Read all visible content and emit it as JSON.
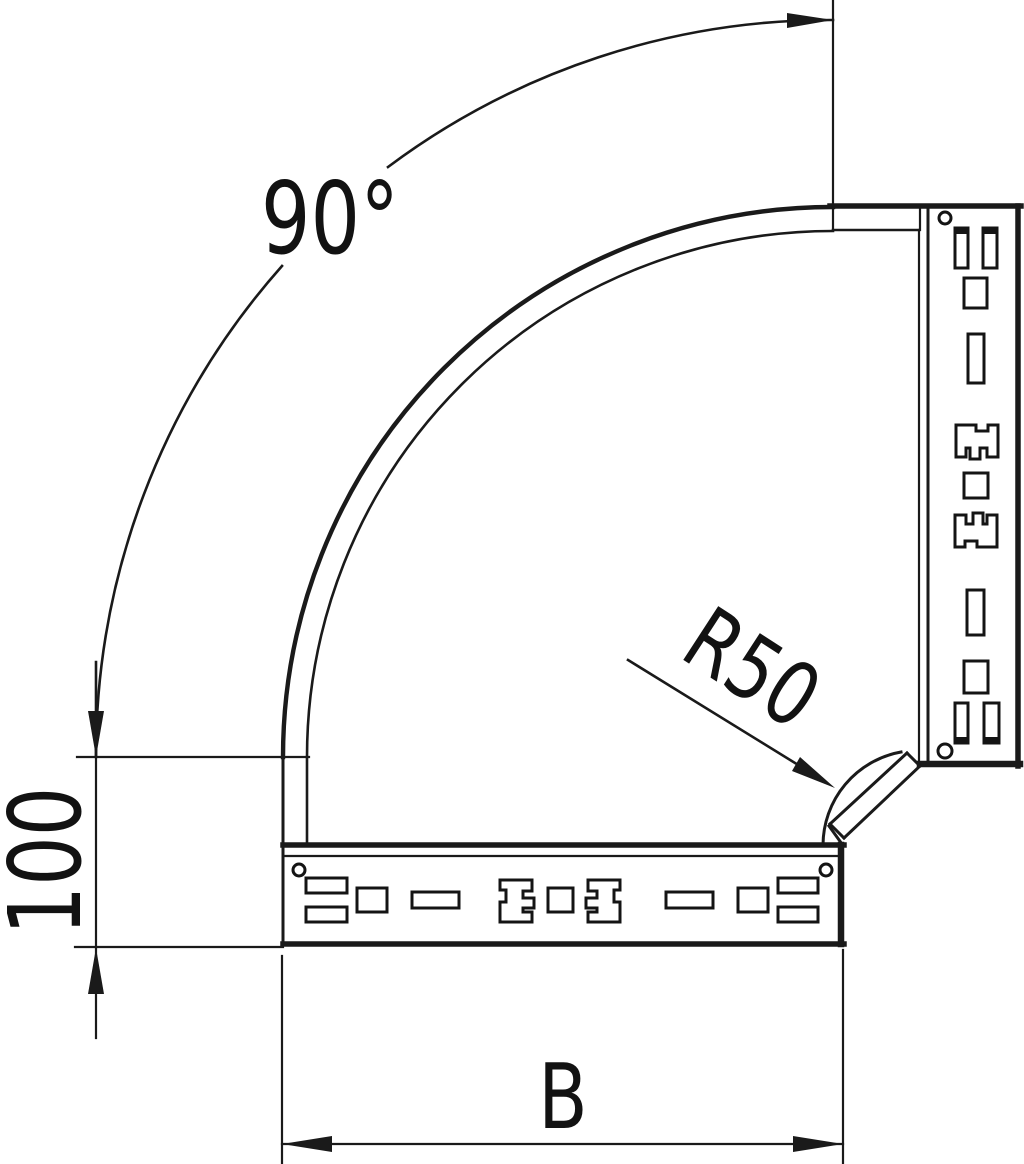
{
  "drawing": {
    "labels": {
      "angle": "90°",
      "radius": "R50",
      "end_length": "100",
      "width": "B"
    },
    "colors": {
      "line": "#1a1a1a",
      "background": "#ffffff"
    }
  }
}
